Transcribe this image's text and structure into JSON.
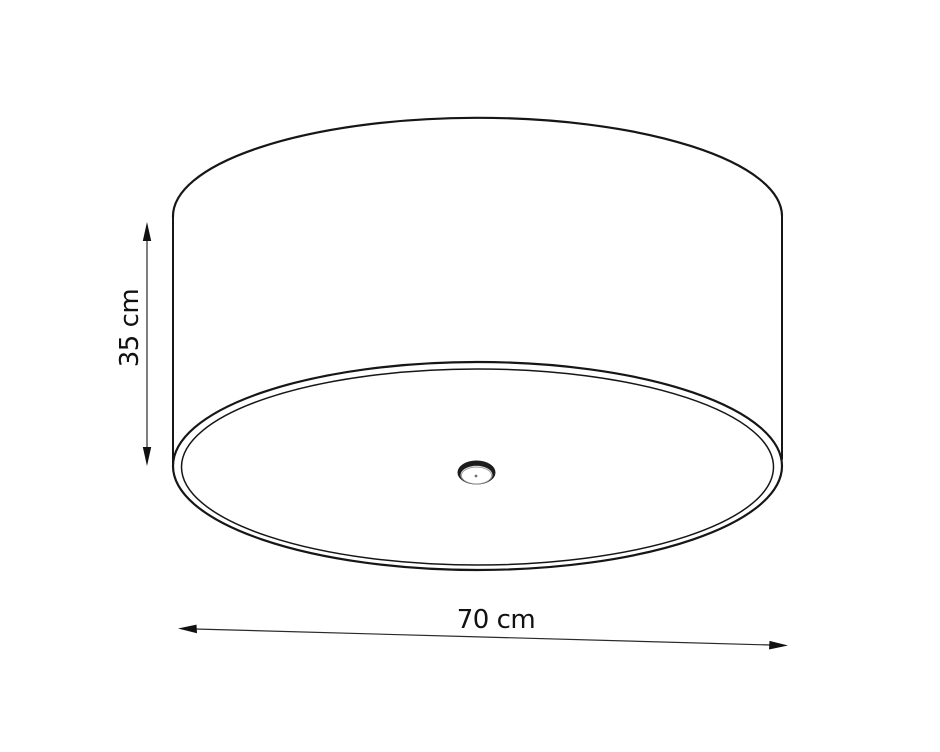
{
  "diagram": {
    "type": "technical-dimension-drawing",
    "subject": "drum ceiling lamp (cylindrical shade with bottom diffuser and center finial)",
    "background_color": "#ffffff",
    "line_color": "#161616",
    "text_color": "#111111",
    "dimensions": {
      "height": {
        "label": "35 cm",
        "value": 35,
        "unit": "cm",
        "orientation": "vertical",
        "measures": "shade height (left side)"
      },
      "diameter": {
        "label": "70 cm",
        "value": 70,
        "unit": "cm",
        "orientation": "horizontal",
        "measures": "shade diameter (bottom width)"
      }
    }
  }
}
